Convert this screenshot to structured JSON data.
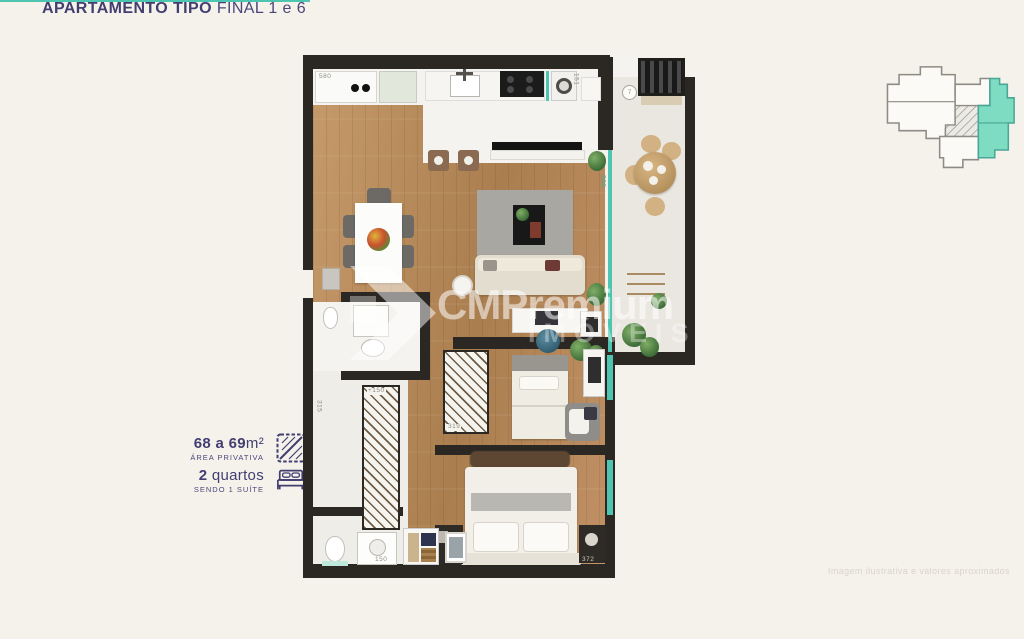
{
  "info": {
    "title_bold": "APARTAMENTO TIPO",
    "title_light": "FINAL 1 e 6",
    "area_value_bold": "68 a 69",
    "area_value_unit": "m²",
    "area_label": "ÁREA PRIVATIVA",
    "rooms_value_bold": "2",
    "rooms_value_normal": " quartos",
    "rooms_label": "SENDO 1 SUÍTE",
    "accent_color": "#4ec5b1",
    "text_color": "#423e70",
    "icons": [
      "area-diagonal-icon",
      "bed-icon"
    ]
  },
  "watermark": {
    "brand": "CMPremium",
    "sub": "IMÓVEIS",
    "logo_icon": "chevron-right-logo"
  },
  "disclaimer": "Imagem ilustrativa e valores aproximados",
  "keyplan": {
    "highlight_color": "#7edcc3",
    "outline_color": "#8d8b84"
  },
  "plan": {
    "labels": {
      "kitchen_counter": "580",
      "washer": "151",
      "balcony_drain": "7",
      "glass_door": "200",
      "hall": "315",
      "wardrobe_hall": "+150",
      "wardrobe_bedroom": "319",
      "vanity": "150",
      "bedroom_width": "372"
    },
    "colors": {
      "wall": "#2b2824",
      "wood_floor": "#b98a5c",
      "balcony_floor": "#eae7e1",
      "glass": "#4ec5b1",
      "rug": "#a9a7a2"
    }
  }
}
